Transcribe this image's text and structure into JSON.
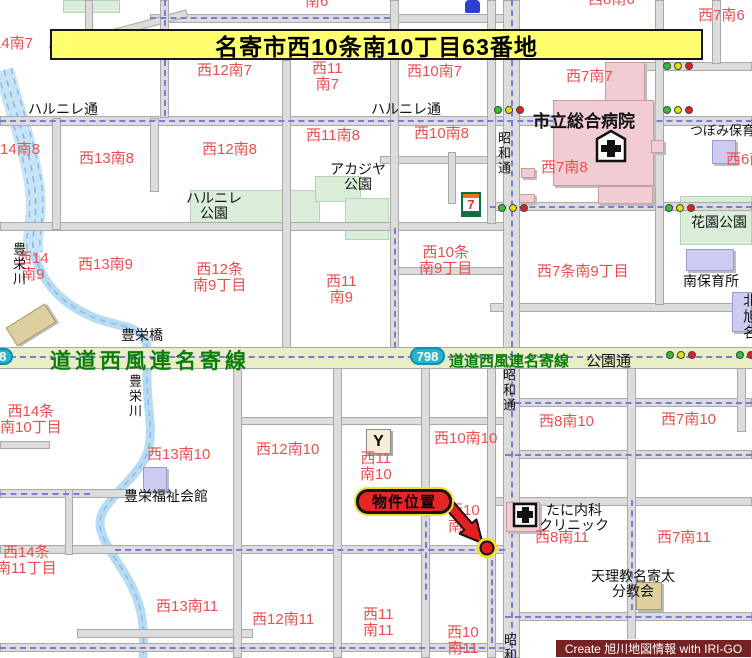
{
  "banner": {
    "text": "名寄市西10条南10丁目63番地"
  },
  "marker": {
    "label": "物件位置"
  },
  "credit": {
    "text": "Create 旭川地図情報 with IRI-GO"
  },
  "route": {
    "shield_number": "798",
    "name_large": "道道西風連名寄線",
    "name_small": "道道西風連名寄線",
    "side_label": "公園通"
  },
  "icons": {
    "seven_label": "7",
    "bar_label": "Y"
  },
  "colors": {
    "block_label": "#e85050",
    "route_name_green": "#0a7d0a",
    "banner_bg": "#ffff70",
    "marker_red": "#e62525",
    "shield_teal": "#25b5cf",
    "credit_maroon": "#772222",
    "lights": {
      "green": "#2fc42f",
      "yellow": "#e2e200",
      "red": "#e62020"
    }
  },
  "block_labels": [
    {
      "x": 305,
      "y": -6,
      "lines": [
        "南6"
      ]
    },
    {
      "x": 588,
      "y": -8,
      "lines": [
        "西8南6"
      ]
    },
    {
      "x": 698,
      "y": 8,
      "lines": [
        "西7南6"
      ]
    },
    {
      "x": -22,
      "y": 36,
      "lines": [
        "西14南7"
      ]
    },
    {
      "x": 197,
      "y": 63,
      "lines": [
        "西12南7"
      ]
    },
    {
      "x": 312,
      "y": 61,
      "lines": [
        "西11",
        "南7"
      ]
    },
    {
      "x": 407,
      "y": 64,
      "lines": [
        "西10南7"
      ]
    },
    {
      "x": 566,
      "y": 69,
      "lines": [
        "西7南7"
      ]
    },
    {
      "x": -15,
      "y": 142,
      "lines": [
        "西14南8"
      ]
    },
    {
      "x": 79,
      "y": 151,
      "lines": [
        "西13南8"
      ]
    },
    {
      "x": 202,
      "y": 142,
      "lines": [
        "西12南8"
      ]
    },
    {
      "x": 306,
      "y": 128,
      "lines": [
        "西11南8"
      ]
    },
    {
      "x": 414,
      "y": 126,
      "lines": [
        "西10南8"
      ]
    },
    {
      "x": 541,
      "y": 160,
      "lines": [
        "西7南8"
      ]
    },
    {
      "x": 726,
      "y": 152,
      "lines": [
        "西6南8"
      ]
    },
    {
      "x": 17,
      "y": 251,
      "lines": [
        "西14",
        "南9"
      ]
    },
    {
      "x": 78,
      "y": 257,
      "lines": [
        "西13南9"
      ]
    },
    {
      "x": 193,
      "y": 262,
      "lines": [
        "西12条",
        "南9丁目"
      ]
    },
    {
      "x": 326,
      "y": 274,
      "lines": [
        "西11",
        "南9"
      ]
    },
    {
      "x": 419,
      "y": 245,
      "lines": [
        "西10条",
        "南9丁目"
      ]
    },
    {
      "x": 537,
      "y": 264,
      "lines": [
        "西7条南9丁目"
      ]
    },
    {
      "x": 0,
      "y": 404,
      "lines": [
        "西14条",
        "南10丁目"
      ]
    },
    {
      "x": 147,
      "y": 447,
      "lines": [
        "西13南10"
      ]
    },
    {
      "x": 256,
      "y": 442,
      "lines": [
        "西12南10"
      ]
    },
    {
      "x": 360,
      "y": 451,
      "lines": [
        "西11",
        "南10"
      ]
    },
    {
      "x": 434,
      "y": 431,
      "lines": [
        "西10南10"
      ]
    },
    {
      "x": 448,
      "y": 503,
      "lines": [
        "西10",
        "南10"
      ]
    },
    {
      "x": 539,
      "y": 414,
      "lines": [
        "西8南10"
      ]
    },
    {
      "x": 661,
      "y": 412,
      "lines": [
        "西7南10"
      ]
    },
    {
      "x": -4,
      "y": 545,
      "lines": [
        "西14条",
        "南11丁目"
      ]
    },
    {
      "x": 156,
      "y": 599,
      "lines": [
        "西13南11"
      ]
    },
    {
      "x": 252,
      "y": 612,
      "lines": [
        "西12南11"
      ]
    },
    {
      "x": 363,
      "y": 607,
      "lines": [
        "西11",
        "南11"
      ]
    },
    {
      "x": 447,
      "y": 625,
      "lines": [
        "西10",
        "南11"
      ]
    },
    {
      "x": 535,
      "y": 530,
      "lines": [
        "西8南11"
      ]
    },
    {
      "x": 657,
      "y": 530,
      "lines": [
        "西7南11"
      ]
    }
  ],
  "place_labels": [
    {
      "x": 28,
      "y": 102,
      "lines": [
        "ハルニレ通"
      ],
      "n": "street-label-harunire-w"
    },
    {
      "x": 371,
      "y": 102,
      "lines": [
        "ハルニレ通"
      ],
      "n": "street-label-harunire-c"
    },
    {
      "x": 186,
      "y": 191,
      "lines": [
        "ハルニレ",
        "公園"
      ],
      "n": "park-label-harunire"
    },
    {
      "x": 330,
      "y": 162,
      "lines": [
        "アカジヤ",
        "公園"
      ],
      "n": "park-label-akajiya"
    },
    {
      "x": 533,
      "y": 113,
      "lines": [
        "市立総合病院"
      ],
      "b": 1,
      "s": 17,
      "n": "hospital-label"
    },
    {
      "x": 690,
      "y": 124,
      "lines": [
        "つぼみ保育"
      ],
      "s": 13,
      "n": "nursery-label-tsubomi"
    },
    {
      "x": 691,
      "y": 215,
      "lines": [
        "花園公園"
      ],
      "n": "park-label-hanazono"
    },
    {
      "x": 683,
      "y": 274,
      "lines": [
        "南保育所"
      ],
      "n": "nursery-label-minami"
    },
    {
      "x": 742,
      "y": 293,
      "lines": [
        "北旭名"
      ],
      "v": 1,
      "n": "clipped-label-right-edge"
    },
    {
      "x": 121,
      "y": 328,
      "lines": [
        "豊栄橋"
      ],
      "n": "bridge-label-hoei"
    },
    {
      "x": 11,
      "y": 242,
      "lines": [
        "豊栄川"
      ],
      "v": 1,
      "s": 13,
      "n": "river-label-hoei-1"
    },
    {
      "x": 127,
      "y": 374,
      "lines": [
        "豊栄川"
      ],
      "v": 1,
      "s": 13,
      "n": "river-label-hoei-2"
    },
    {
      "x": 496,
      "y": 131,
      "lines": [
        "昭和通"
      ],
      "v": 1,
      "s": 13,
      "n": "street-label-showa-1"
    },
    {
      "x": 501,
      "y": 368,
      "lines": [
        "昭和通"
      ],
      "v": 1,
      "s": 13,
      "n": "street-label-showa-2"
    },
    {
      "x": 502,
      "y": 633,
      "lines": [
        "昭和通"
      ],
      "v": 1,
      "s": 13,
      "n": "street-label-showa-3"
    },
    {
      "x": 124,
      "y": 489,
      "lines": [
        "豊栄福祉会館"
      ],
      "n": "hall-label-hoei-fukushi"
    },
    {
      "x": 539,
      "y": 503,
      "lines": [
        "たに内科",
        "クリニック"
      ],
      "n": "clinic-label-tani"
    },
    {
      "x": 591,
      "y": 569,
      "lines": [
        "天理教名寄太",
        "分教会"
      ],
      "n": "church-label-tenrikyo"
    }
  ],
  "signals": [
    {
      "x": 494,
      "y": 106,
      "lights": [
        "green",
        "yellow",
        "red"
      ]
    },
    {
      "x": 663,
      "y": 62,
      "lights": [
        "green",
        "yellow",
        "red"
      ]
    },
    {
      "x": 663,
      "y": 106,
      "lights": [
        "green",
        "yellow",
        "red"
      ]
    },
    {
      "x": 498,
      "y": 204,
      "lights": [
        "green",
        "yellow",
        "red"
      ]
    },
    {
      "x": 665,
      "y": 204,
      "lights": [
        "green",
        "yellow",
        "red"
      ]
    },
    {
      "x": 666,
      "y": 351,
      "lights": [
        "green",
        "yellow",
        "red"
      ]
    },
    {
      "x": 736,
      "y": 351,
      "lights": [
        "green",
        "red"
      ]
    }
  ]
}
